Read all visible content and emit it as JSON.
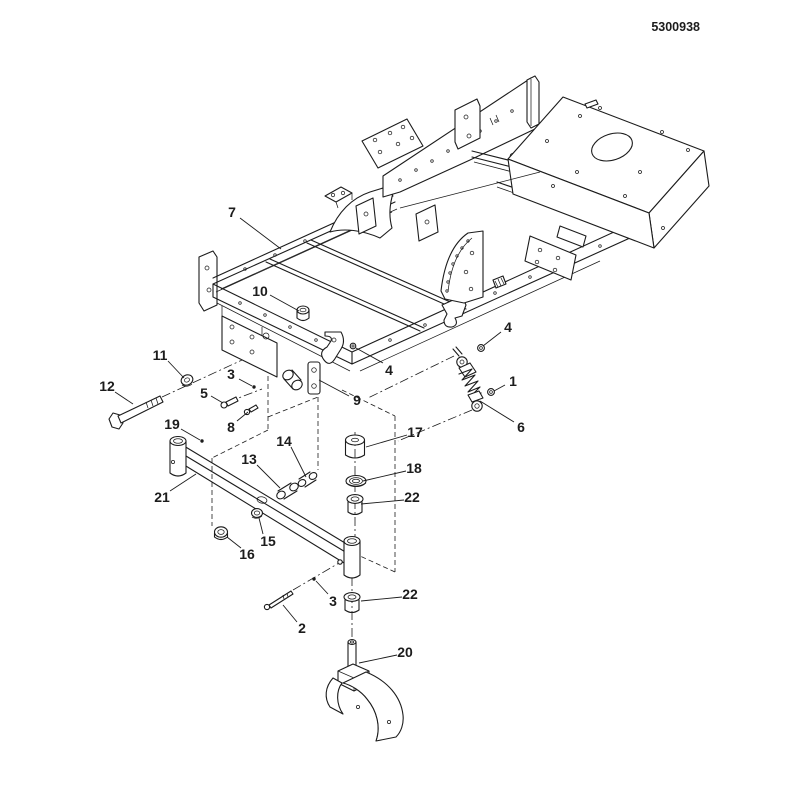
{
  "page": {
    "background": "#ffffff",
    "ink_color": "#1c1c1c",
    "doc_number": "5300938"
  },
  "diagram": {
    "kind": "exploded-parts-diagram",
    "subject": "frame-and-front-caster-arm-assembly",
    "callouts": [
      {
        "n": "7",
        "tx": 232,
        "ty": 212,
        "line": [
          240,
          218,
          281,
          249
        ]
      },
      {
        "n": "10",
        "tx": 260,
        "ty": 291,
        "line": [
          270,
          295,
          299,
          311
        ]
      },
      {
        "n": "4",
        "tx": 389,
        "ty": 370,
        "line": [
          383,
          363,
          356,
          348
        ]
      },
      {
        "n": "4",
        "tx": 508,
        "ty": 327,
        "line": [
          501,
          332,
          483,
          346
        ]
      },
      {
        "n": "1",
        "tx": 513,
        "ty": 381,
        "line": [
          505,
          385,
          494,
          391
        ]
      },
      {
        "n": "6",
        "tx": 521,
        "ty": 427,
        "line": [
          514,
          422,
          480,
          401
        ]
      },
      {
        "n": "11",
        "tx": 160,
        "ty": 355,
        "line": [
          168,
          361,
          184,
          378
        ]
      },
      {
        "n": "12",
        "tx": 107,
        "ty": 386,
        "line": [
          115,
          392,
          133,
          404
        ]
      },
      {
        "n": "5",
        "tx": 204,
        "ty": 393,
        "line": [
          211,
          396,
          223,
          403
        ]
      },
      {
        "n": "3",
        "tx": 231,
        "ty": 374,
        "line": [
          239,
          379,
          252,
          386
        ]
      },
      {
        "n": "8",
        "tx": 231,
        "ty": 427,
        "line": [
          237,
          421,
          248,
          412
        ]
      },
      {
        "n": "9",
        "tx": 357,
        "ty": 400,
        "line": [
          349,
          396,
          319,
          380
        ]
      },
      {
        "n": "19",
        "tx": 172,
        "ty": 424,
        "line": [
          181,
          429,
          200,
          440
        ]
      },
      {
        "n": "21",
        "tx": 162,
        "ty": 497,
        "line": [
          170,
          491,
          196,
          474
        ]
      },
      {
        "n": "13",
        "tx": 249,
        "ty": 459,
        "line": [
          257,
          465,
          280,
          488
        ]
      },
      {
        "n": "14",
        "tx": 284,
        "ty": 441,
        "line": [
          291,
          447,
          306,
          477
        ]
      },
      {
        "n": "17",
        "tx": 415,
        "ty": 432,
        "line": [
          407,
          435,
          366,
          447
        ]
      },
      {
        "n": "18",
        "tx": 414,
        "ty": 468,
        "line": [
          406,
          471,
          363,
          481
        ]
      },
      {
        "n": "22",
        "tx": 412,
        "ty": 497,
        "line": [
          404,
          500,
          361,
          504
        ]
      },
      {
        "n": "15",
        "tx": 268,
        "ty": 541,
        "line": [
          263,
          534,
          259,
          518
        ]
      },
      {
        "n": "16",
        "tx": 247,
        "ty": 554,
        "line": [
          241,
          548,
          227,
          537
        ]
      },
      {
        "n": "3",
        "tx": 333,
        "ty": 601,
        "line": [
          328,
          594,
          316,
          581
        ]
      },
      {
        "n": "22",
        "tx": 410,
        "ty": 594,
        "line": [
          402,
          597,
          361,
          601
        ]
      },
      {
        "n": "2",
        "tx": 302,
        "ty": 628,
        "line": [
          297,
          622,
          283,
          605
        ]
      },
      {
        "n": "20",
        "tx": 405,
        "ty": 652,
        "line": [
          397,
          655,
          359,
          663
        ]
      }
    ]
  }
}
